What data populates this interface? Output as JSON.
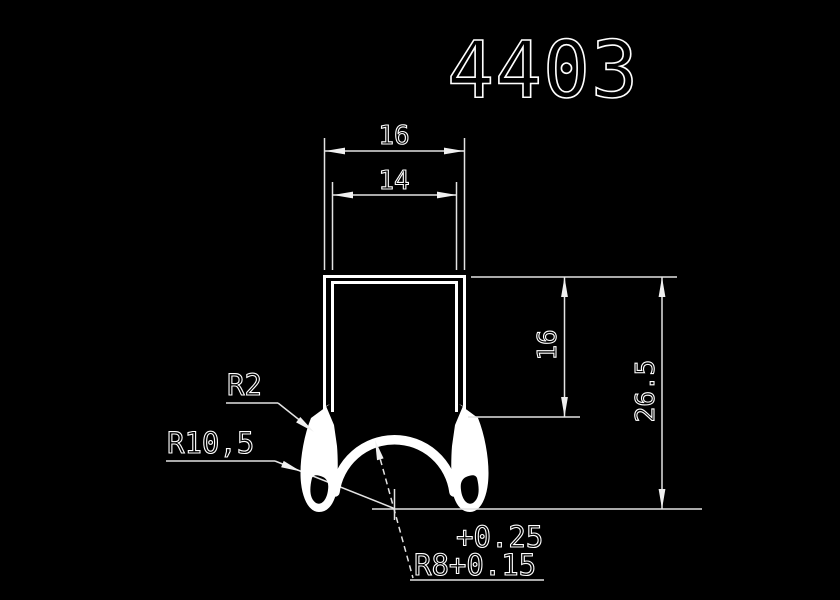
{
  "app": {
    "background_color": "#000000",
    "line_color": "#ffffff"
  },
  "drawing": {
    "title": "4403",
    "dimensions": {
      "outer_width": "16",
      "inner_width": "14",
      "wall_height": "16",
      "total_height": "26.5"
    },
    "callouts": {
      "step_radius": "R2",
      "foot_radius": "R10,5",
      "arch_tolerance_upper": "+0.25",
      "arch_radius": "R8+0.15"
    }
  }
}
